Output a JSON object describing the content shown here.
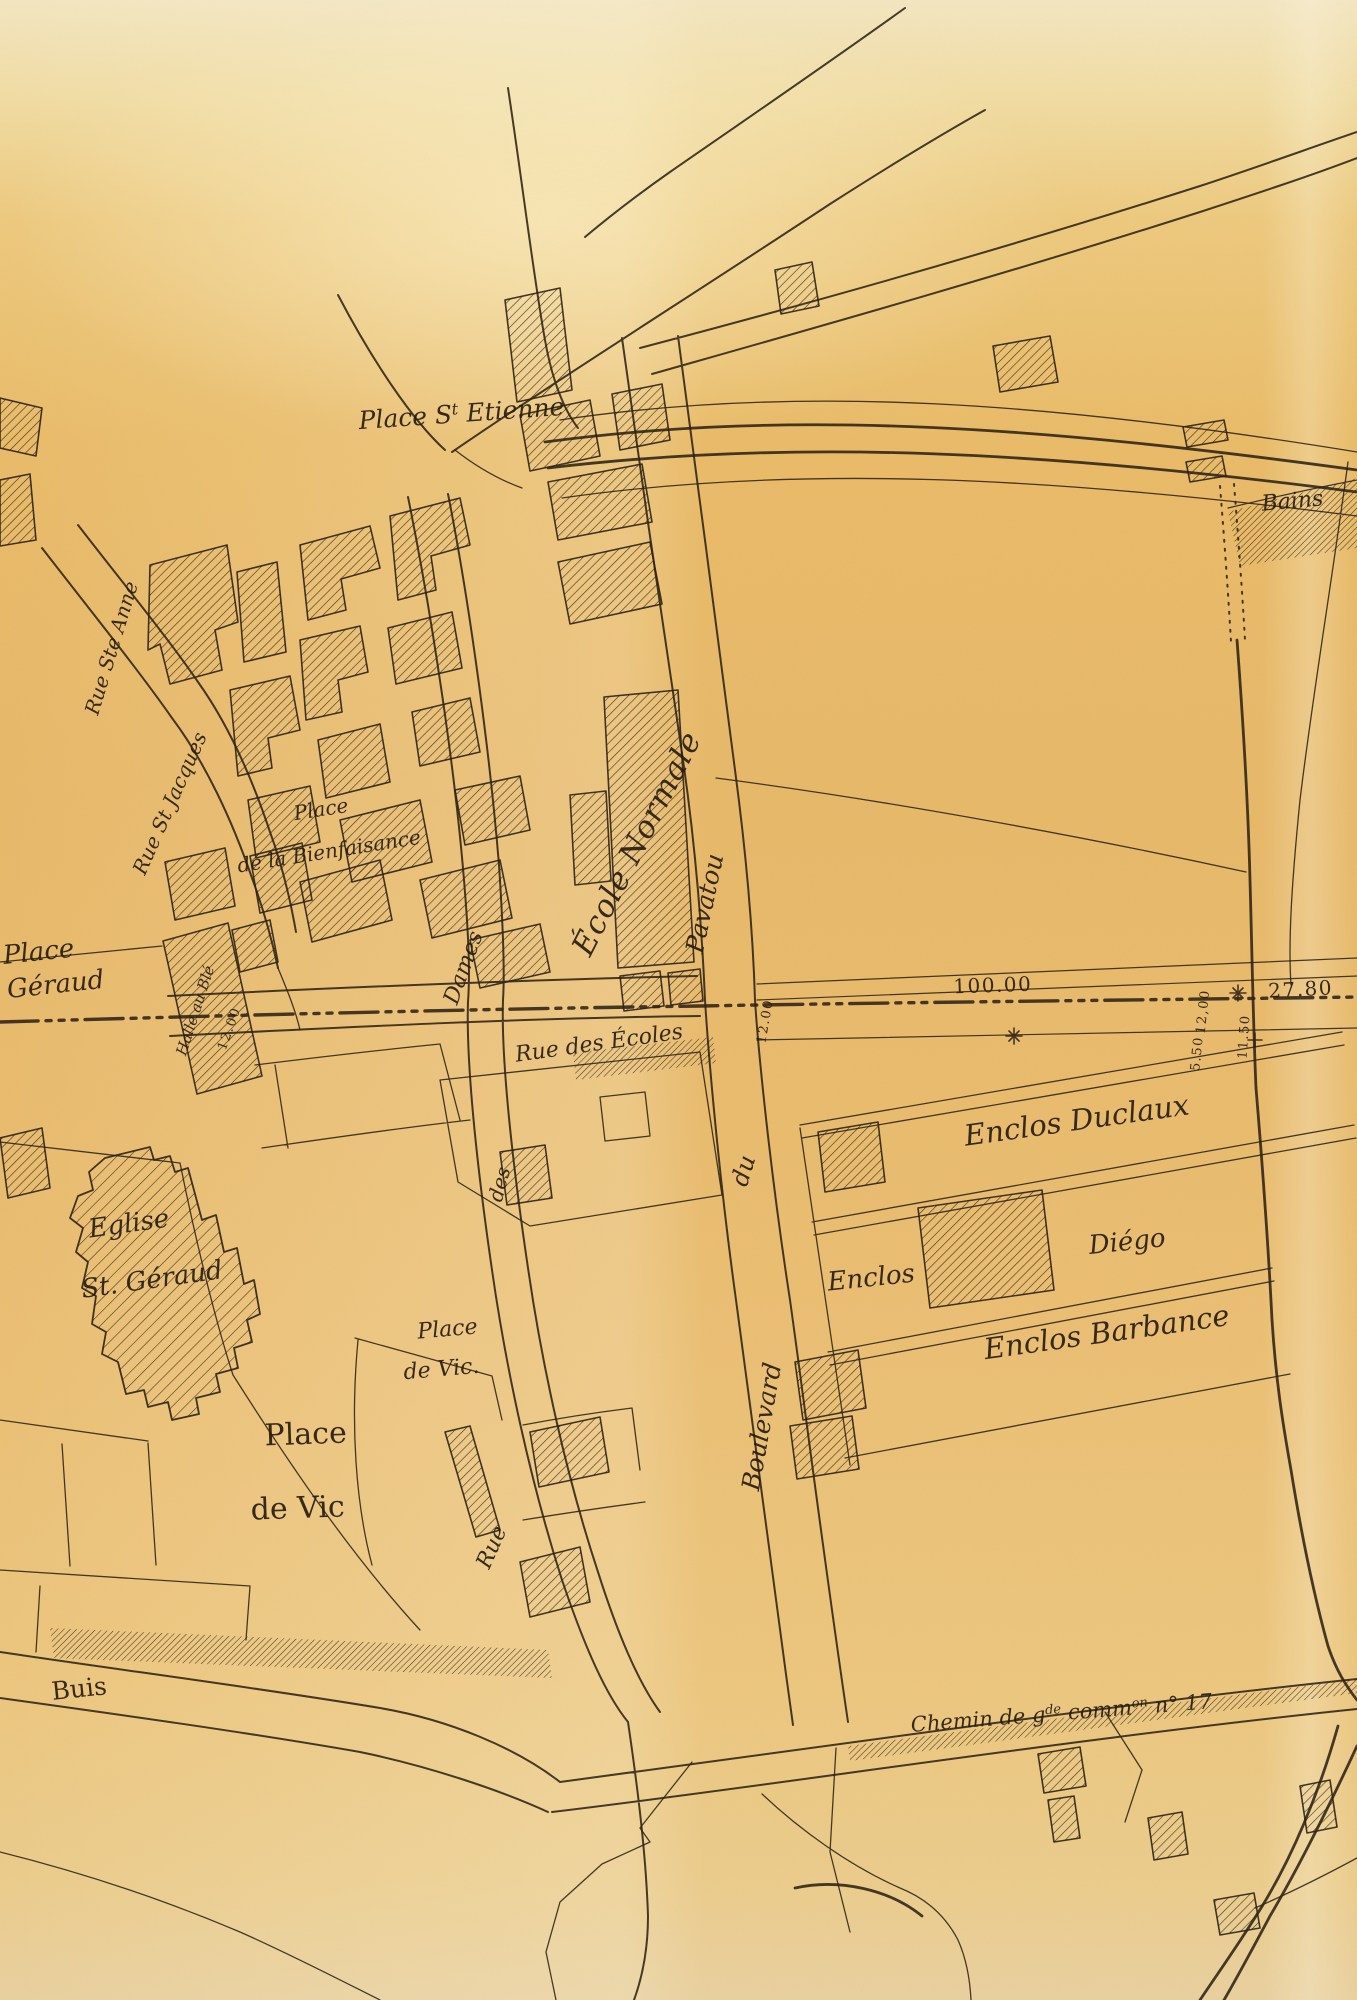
{
  "paper": {
    "base_color": "#e9bd71",
    "light_band_color": "#f2dfa9",
    "ink_color": "#2b2012"
  },
  "labels": {
    "place_st_etienne": {
      "p1": "Place S",
      "sup": "t",
      "p2": " Etienne"
    },
    "bains": "Bains",
    "rue_ste_anne": "Rue Ste Anne",
    "rue_st_jacques": "Rue St Jacques",
    "place_bienfaisance_1": "Place",
    "place_bienfaisance_2": "de la Bienfaisance",
    "ecole_normale": "École Normale",
    "pavatou": "Pavatou",
    "du": "du",
    "boulevard": "Boulevard",
    "halle_au_ble": "Halle au Blé",
    "place_geraud_1": "Place",
    "place_geraud_2": "Géraud",
    "rue_des_ecoles": "Rue des Écoles",
    "dames": "Dames",
    "des": "des",
    "rue": "Rue",
    "eglise_1": "Eglise",
    "eglise_2": "St. Géraud",
    "place_vic_small_1": "Place",
    "place_vic_small_2": "de Vic.",
    "place_vic_large_1": "Place",
    "place_vic_large_2": "de Vic",
    "enclos_duclaux": "Enclos Duclaux",
    "enclos": "Enclos",
    "diego": "Diégo",
    "enclos_barbance": "Enclos Barbance",
    "buis": "Buis",
    "chemin": {
      "p1": "Chemin de g",
      "s1": "de",
      "p2": " comm",
      "s2": "on",
      "p3": " n° 17"
    }
  },
  "measurements": {
    "m100": "100.00",
    "m2780": "27.80",
    "m12a": "12.00",
    "m12b": "12,00",
    "m550": "5.50",
    "m1150": "11.50",
    "m12c": "12.00"
  }
}
